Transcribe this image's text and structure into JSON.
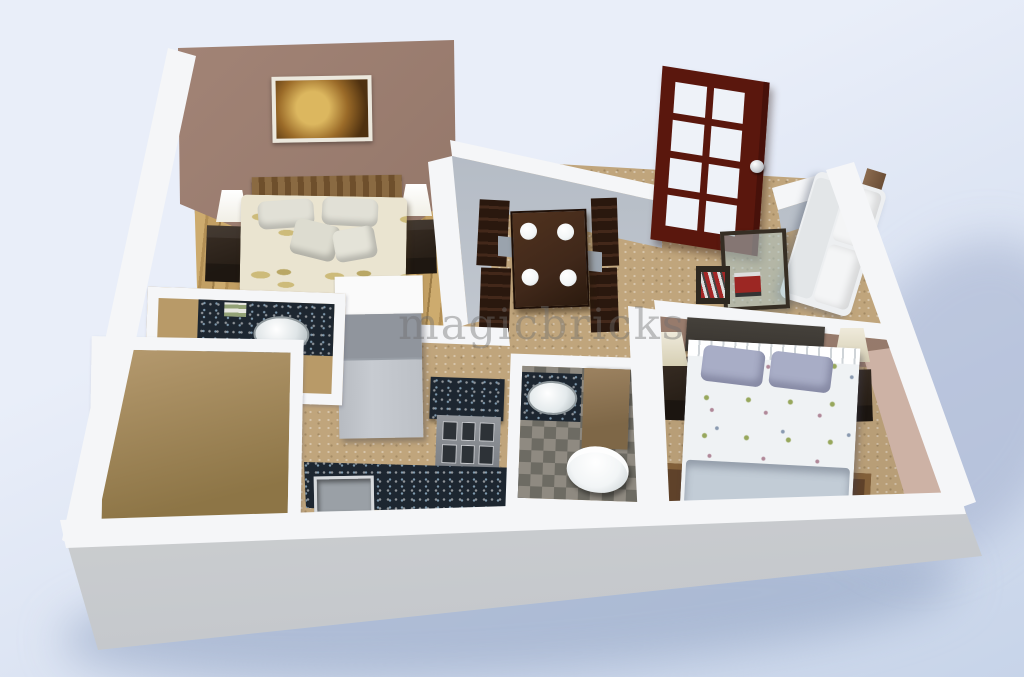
{
  "scene": {
    "kind": "3d-isometric-floor-plan-render",
    "description": "Top-down 3D render of a one-bedroom-hall-kitchen apartment with two bedrooms, dining area, kitchen, two bathrooms, sofa and entry door",
    "width_px": 1024,
    "height_px": 677
  },
  "watermark": {
    "text": "magicbricks"
  },
  "palette": {
    "bg1": "#e9eef9",
    "bg2": "#c7d4e9",
    "wallTop": "#f5f6f8",
    "wallFace": "#d9dde2",
    "wallFaceDark": "#aab2bd",
    "slabFaceA": "#e2e3e2",
    "slabFaceB": "#c0c4ca",
    "floorTan": "#c0a57c",
    "floorTanDark": "#a8placeholder",
    "plankA": "#cdab6e",
    "plankB": "#b28f55",
    "plankC": "#c29f63",
    "plankD": "#9c7c47",
    "accent1a": "#a8897b",
    "accent1b": "#8d7164",
    "accent2": "#a08374",
    "granite": "#1d2630",
    "graniteFleck": "#7e98ac",
    "tileA": "#77746c",
    "tileB": "#9b968c",
    "porcelain": "#f2f5f6",
    "doorWood": "#5a170d",
    "pane": "#eef2f8",
    "knob": "#c6cacf",
    "tableWood": "#40281a",
    "chairWood": "#2a180e",
    "seatGray": "#9aa3ad",
    "sofa": "#edeff1",
    "sofaFrame": "#85634a",
    "glass": "#a9c4c9",
    "bookRed": "#9c2723",
    "duvet1": "#eae4d0",
    "floral1": "#cdbb7a",
    "pillow1": "#e1e0d6",
    "duvet2": "#eff2f4",
    "floral2": "#97a75c",
    "floral2b": "#b08898",
    "pillow2": "#a8adc6",
    "head1a": "#8a6a42",
    "head1b": "#6e4f2c",
    "head2": "#38342f",
    "stand": "#281f17",
    "shade1": "#f1efe6",
    "shade2": "#d6cfb4",
    "rug": "#5f422a",
    "rugBorder": "#82603a",
    "marbleWall": "#9c8260",
    "fridgeTop": "#fafafa",
    "fridgeBody": "#c7cbd1",
    "steel": "#aeb3b9",
    "watermark": "#6f6f6f"
  },
  "rooms": [
    {
      "id": "master-bedroom",
      "furniture": [
        "accent-wall",
        "wall-art",
        "double-bed-floral",
        "pillows",
        "headboard",
        "nightstand-x2",
        "table-lamp-x2",
        "wood-floor",
        "runner-rug"
      ]
    },
    {
      "id": "master-bathroom",
      "furniture": [
        "granite-vanity",
        "round-basin",
        "toilet",
        "towels"
      ]
    },
    {
      "id": "utility-room",
      "furniture": []
    },
    {
      "id": "kitchen",
      "furniture": [
        "l-shaped-granite-counter",
        "sink",
        "hob-unit",
        "refrigerator"
      ]
    },
    {
      "id": "dining-area",
      "furniture": [
        "dining-table",
        "chair-x4",
        "place-setting-x4"
      ]
    },
    {
      "id": "entry-living",
      "furniture": [
        "glazed-entry-door",
        "white-sofa",
        "glass-coffee-table",
        "magazine-rack"
      ]
    },
    {
      "id": "common-bathroom",
      "furniture": [
        "basin-counter",
        "toilet",
        "half-wall",
        "checkered-floor"
      ]
    },
    {
      "id": "second-bedroom",
      "furniture": [
        "accent-wall",
        "double-bed-floral",
        "pillow-x2",
        "headboard",
        "nightstand-x2",
        "table-lamp-x2",
        "area-rug"
      ]
    }
  ]
}
